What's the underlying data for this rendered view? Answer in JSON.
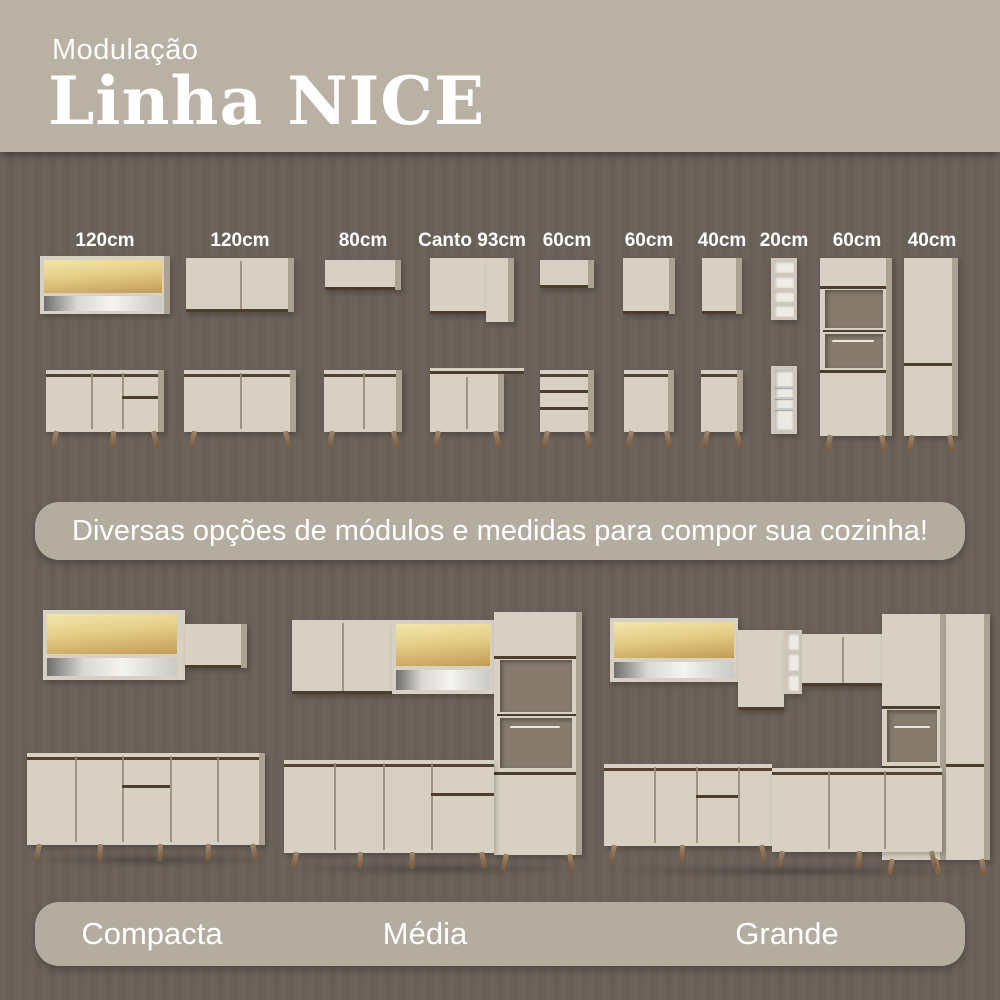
{
  "header": {
    "subtitle": "Modulação",
    "title": "Linha NICE"
  },
  "modules": [
    {
      "label": "120cm"
    },
    {
      "label": "120cm"
    },
    {
      "label": "80cm"
    },
    {
      "label": "Canto 93cm"
    },
    {
      "label": "60cm"
    },
    {
      "label": "60cm"
    },
    {
      "label": "40cm"
    },
    {
      "label": "20cm"
    },
    {
      "label": "60cm"
    },
    {
      "label": "40cm"
    }
  ],
  "banner": {
    "text": "Diversas opções de módulos e medidas para compor sua cozinha!"
  },
  "kitchens": [
    {
      "label": "Compacta"
    },
    {
      "label": "Média"
    },
    {
      "label": "Grande"
    }
  ],
  "colors": {
    "header_bg": "#b8b1a4",
    "page_bg": "#6a6159",
    "banner_bg": "#b3ac9f",
    "cabinet_face": "#d8d1c3",
    "glass_yellow": "#e4cd86",
    "wood_leg": "#8f7456",
    "text": "#ffffff"
  }
}
